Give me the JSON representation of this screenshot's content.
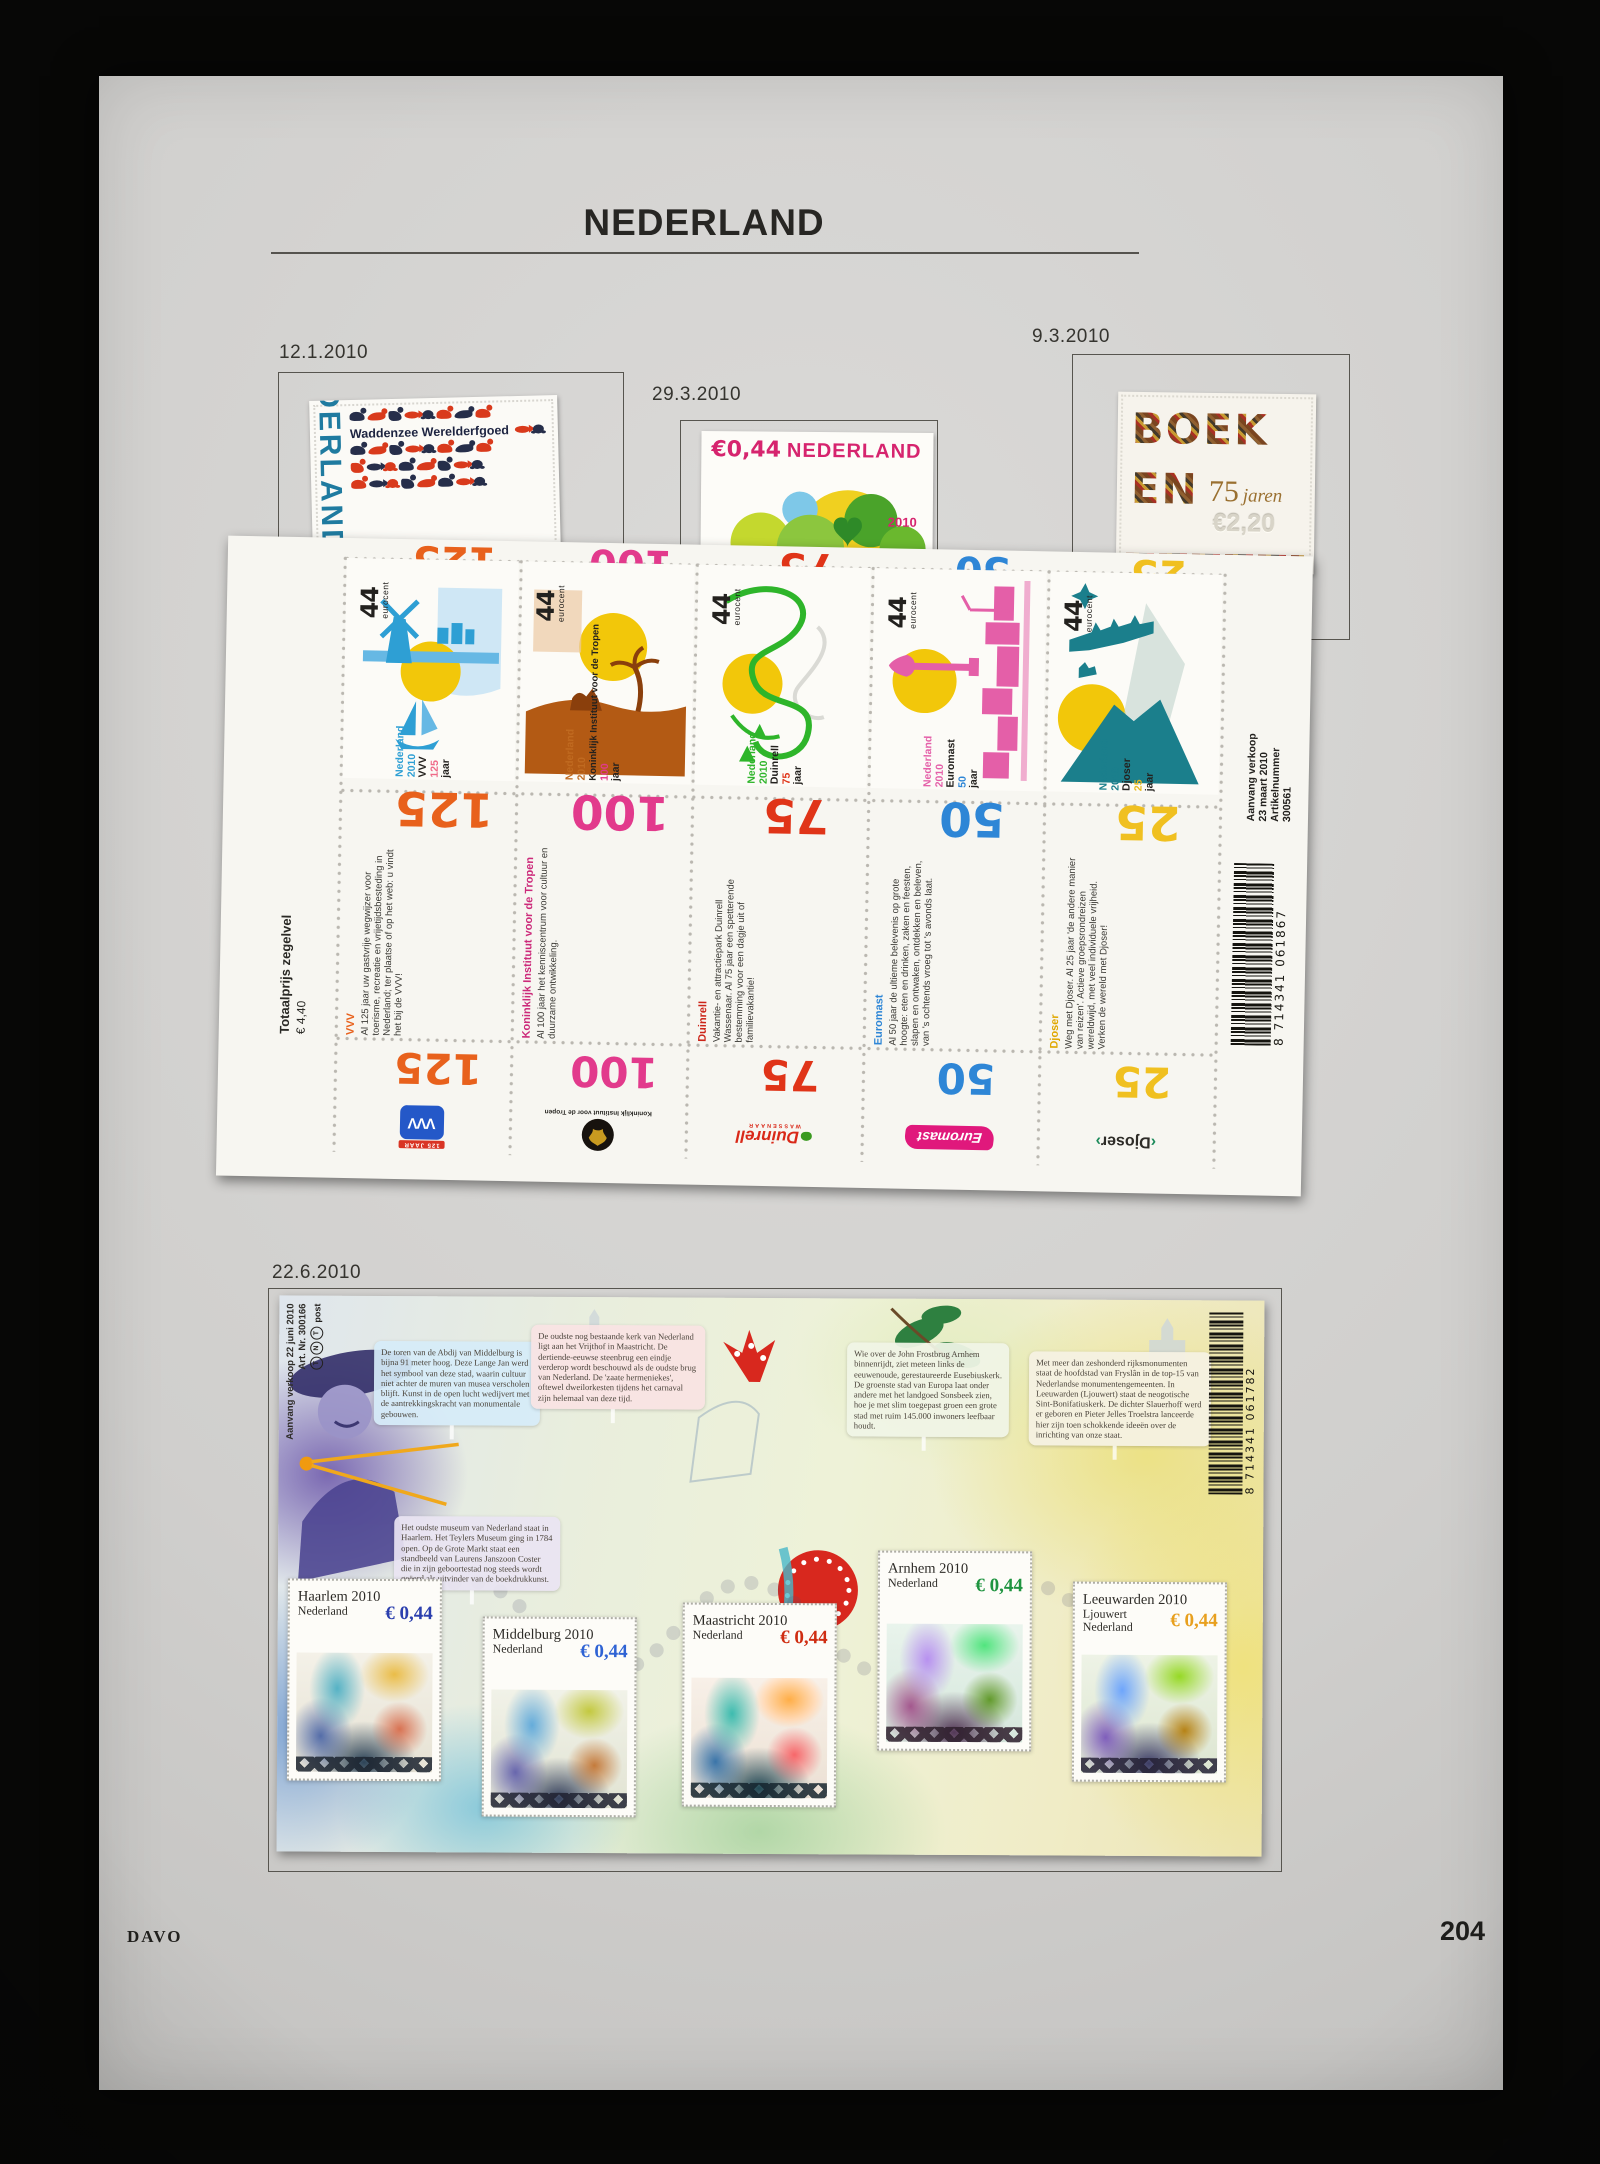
{
  "album": {
    "title": "NEDERLAND",
    "publisher": "DAVO",
    "page_number": "204"
  },
  "issues": {
    "waddenzee": {
      "date": "12.1.2010",
      "country": "NEDERLAND",
      "caption": "Waddenzee Werelderfgoed"
    },
    "spring": {
      "date": "29.3.2010",
      "value": "€0,44",
      "country": "NEDERLAND",
      "year": "2010"
    },
    "boeken": {
      "date": "9.3.2010",
      "word_top": "BOEK",
      "word_bottom": "EN",
      "anniversary": "75",
      "anniversary_word": "jaren",
      "value": "€2,20"
    }
  },
  "jubilee_sheet": {
    "denomination": "44",
    "denomination_unit": "eurocent",
    "country": "Nederland",
    "year": "2010",
    "jaar": "jaar",
    "stamps": [
      {
        "name": "VVV",
        "number": "125",
        "accent": "#2e9fd4",
        "number_color": "#e8611c"
      },
      {
        "name": "Koninklijk Instituut voor de Tropen",
        "number": "100",
        "accent": "#b35a14",
        "number_color": "#e23a8c"
      },
      {
        "name": "Duinrell",
        "number": "75",
        "accent": "#2eb52a",
        "number_color": "#e03418"
      },
      {
        "name": "Euromast",
        "number": "50",
        "accent": "#e45fa8",
        "number_color": "#2e86d6"
      },
      {
        "name": "Djoser",
        "number": "25",
        "accent": "#1b7f8c",
        "number_color": "#f0c020"
      }
    ],
    "price_label": "Totaalprijs zegelvel",
    "price_value": "€ 4,40",
    "descriptions": [
      {
        "title": "VVV",
        "text": "Al 125 jaar uw gastvrije wegwijzer voor toerisme, recreatie en vrijetijdsbesteding in Nederland; ter plaatse of op het web: u vindt het bij de VVV!"
      },
      {
        "title": "Koninklijk Instituut voor de Tropen",
        "text": "Al 100 jaar het kenniscentrum voor cultuur en duurzame ontwikkeling."
      },
      {
        "title": "Duinrell",
        "text": "Vakantie- en attractiepark Duinrell Wassenaar. Al 75 jaar een spetterende bestemming voor een dagje uit of familievakantie!"
      },
      {
        "title": "Euromast",
        "text": "Al 50 jaar de ultieme belevenis op grote hoogte: eten en drinken, zaken en feesten, slapen en ontwaken, ontdekken en beleven, van 's ochtends vroeg tot 's avonds laat."
      },
      {
        "title": "Djoser",
        "text": "Weg met Djoser. Al 25 jaar 'de andere manier van reizen'. Actieve groepsrondreizen wereldwijd, met veel individuele vrijheid. Verken de wereld met Djoser!"
      }
    ],
    "sale_lines": [
      "Aanvang verkoop",
      "23 maart 2010",
      "Artikelnummer",
      "300561"
    ],
    "barcode": "8 714341 061867",
    "logos": {
      "vvv": "VVV",
      "vvv_sub": "125 JAAR",
      "kit": "Koninklijk Instituut voor de Tropen",
      "duinrell": "Duinrell",
      "duinrell_sub": "WASSENAAR",
      "euromast": "Euromast",
      "djoser": "Djoser"
    }
  },
  "city_sheet": {
    "date": "22.6.2010",
    "margin_line_1": "Aanvang verkoop 22 juni 2010",
    "margin_line_2": "Art. Nr. 300166",
    "tnt_letters": [
      "T",
      "N",
      "T"
    ],
    "tnt_word": "post",
    "barcode": "8 714341 061782",
    "notes": [
      {
        "about": "Middelburg",
        "text": "De toren van de Abdij van Middelburg is bijna 91 meter hoog. Deze Lange Jan werd het symbool van deze stad, waarin cultuur niet achter de muren van musea verscholen blijft. Kunst in de open lucht wedijvert met de aantrekkingskracht van monumentale gebouwen."
      },
      {
        "about": "Maastricht",
        "text": "De oudste nog bestaande kerk van Nederland ligt aan het Vrijthof in Maastricht. De dertiende-eeuwse steenbrug een eindje verderop wordt beschouwd als de oudste brug van Nederland. De 'zaate hermeniekes', oftewel dweilorkesten tijdens het carnaval zijn helemaal van deze tijd."
      },
      {
        "about": "Haarlem",
        "text": "Het oudste museum van Nederland staat in Haarlem. Het Teylers Museum ging in 1784 open. Op de Grote Markt staat een standbeeld van Laurens Janszoon Coster die in zijn geboortestad nog steeds wordt geëerd als uitvinder van de boekdrukkunst."
      },
      {
        "about": "Arnhem",
        "text": "Wie over de John Frostbrug Arnhem binnenrijdt, ziet meteen links de eeuwenoude, gerestaureerde Eusebiuskerk. De groenste stad van Europa laat onder andere met het landgoed Sonsbeek zien, hoe je met slim toegepast groen een grote stad met ruim 145.000 inwoners leefbaar houdt."
      },
      {
        "about": "Leeuwarden",
        "text": "Met meer dan zeshonderd rijksmonumenten staat de hoofdstad van Fryslân in de top-15 van Nederlandse monumentengemeenten. In Leeuwarden (Ljouwert) staat de neogotische Sint-Bonifatiuskerk. De dichter Slauerhoff werd er geboren en Pieter Jelles Troelstra lanceerde hier zijn toen schokkende ideeën over de inrichting van onze staat."
      }
    ],
    "stamps": [
      {
        "city": "Haarlem 2010",
        "line2": "Nederland",
        "value": "€ 0,44",
        "value_color": "#2b3fae"
      },
      {
        "city": "Middelburg 2010",
        "line2": "Nederland",
        "value": "€ 0,44",
        "value_color": "#2f63d4"
      },
      {
        "city": "Maastricht 2010",
        "line2": "Nederland",
        "value": "€ 0,44",
        "value_color": "#cf2d12"
      },
      {
        "city": "Arnhem 2010",
        "line2": "Nederland",
        "value": "€ 0,44",
        "value_color": "#1f9440"
      },
      {
        "city": "Leeuwarden 2010",
        "line2": "Ljouwert",
        "line3": "Nederland",
        "value": "€ 0,44",
        "value_color": "#e8a01f"
      }
    ]
  }
}
